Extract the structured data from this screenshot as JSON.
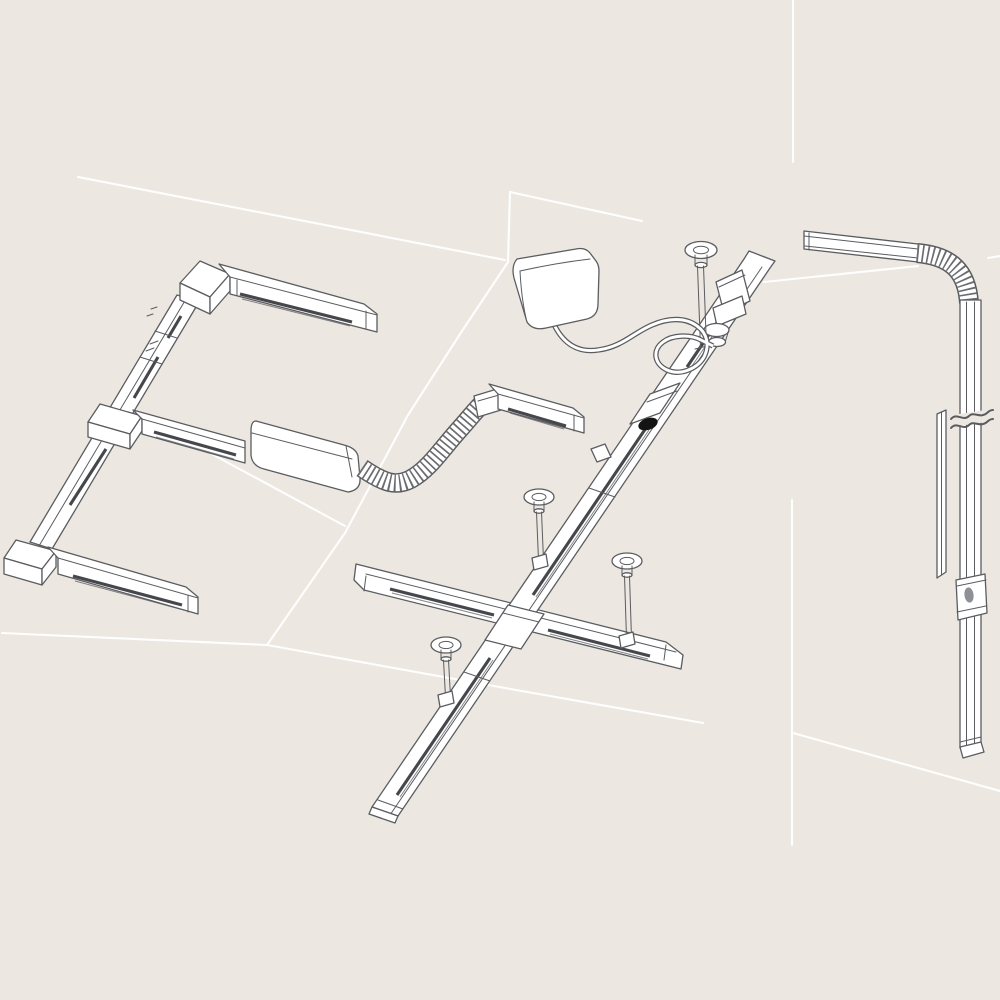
{
  "scene": {
    "background": "#ece8e1",
    "outline": "#5b5c60",
    "slot": "#46474b",
    "fill": "#ffffff",
    "highlight": "#ffffff",
    "feed_dot": "#141414",
    "connector_dot": "#8e9095"
  },
  "illustration": {
    "visible_text": [],
    "components": [
      {
        "id": "left-track-run",
        "name": "surface-mounted track run with corner and T connectors"
      },
      {
        "id": "feed-adapter-box",
        "name": "track adapter box"
      },
      {
        "id": "flex-connector",
        "name": "corrugated flexible track connector"
      },
      {
        "id": "short-rail",
        "name": "short track rail"
      },
      {
        "id": "suspended-track",
        "name": "suspended track with cross connector and ceiling pendants"
      },
      {
        "id": "power-feed-box",
        "name": "power supply box with feed cable"
      },
      {
        "id": "feed-point-dot",
        "name": "track feed point"
      },
      {
        "id": "wall-track",
        "name": "vertical wall track with 90-degree flex corner, break mark, cover profile and connector"
      }
    ]
  }
}
